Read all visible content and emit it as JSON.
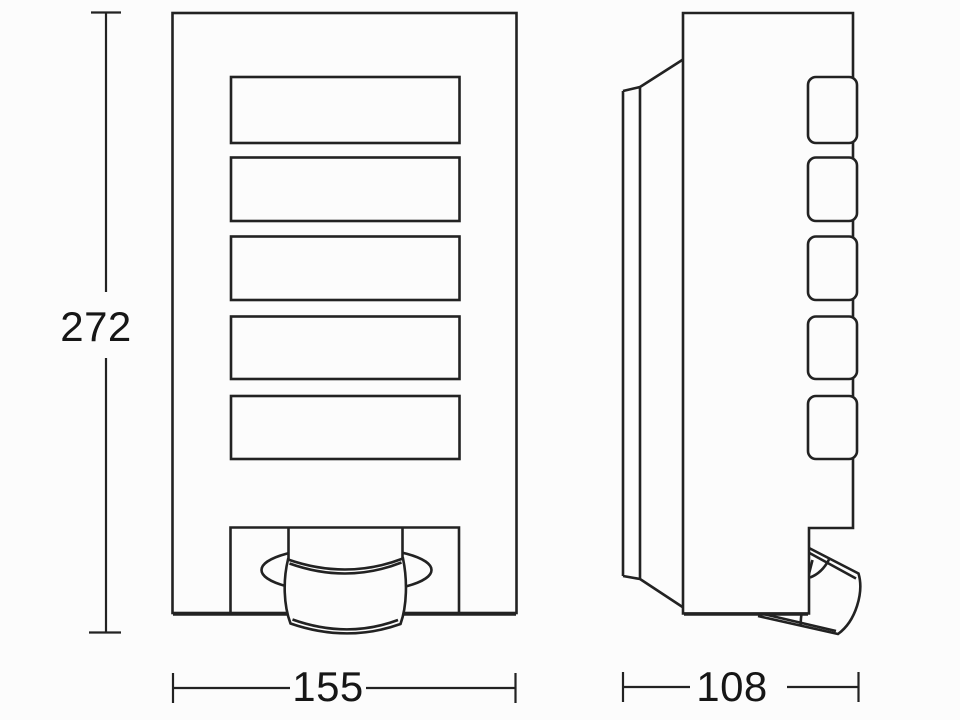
{
  "drawing": {
    "dimensions": {
      "height": "272",
      "width": "155",
      "depth": "108"
    },
    "style": {
      "background": "#fcfcfc",
      "stroke": "#222222",
      "text": "#161616"
    },
    "front_view": {
      "slot_count": 5
    },
    "side_view": {
      "slot_count": 5
    }
  }
}
